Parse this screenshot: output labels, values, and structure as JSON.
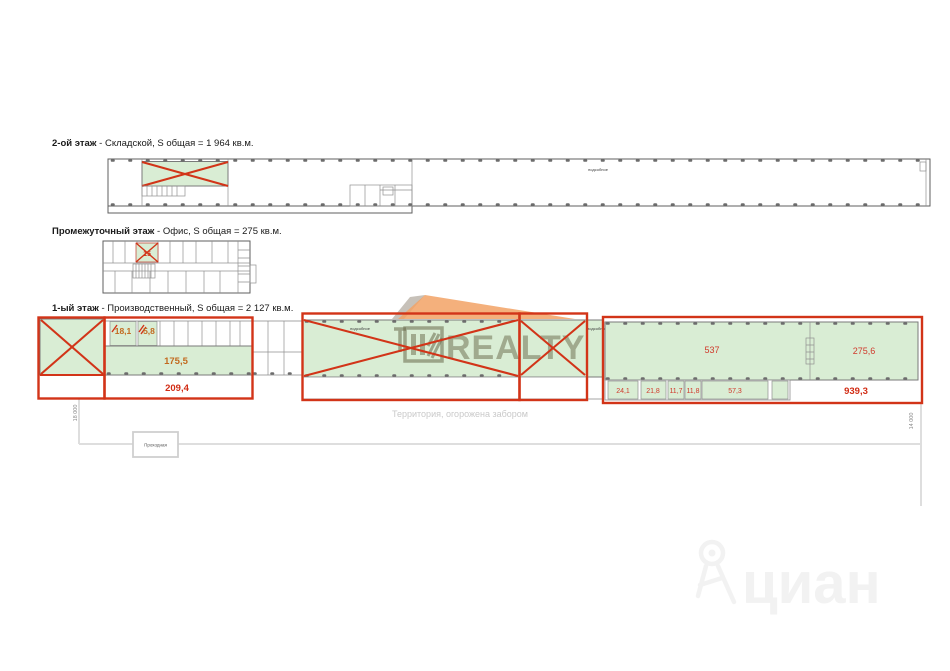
{
  "page": {
    "width": 950,
    "height": 671,
    "background": "#ffffff"
  },
  "floors": [
    {
      "name": "2-ой этаж",
      "info": "- Складской, S общая = 1 964 кв.м."
    },
    {
      "name": "Промежуточный этаж",
      "info": "- Офис, S общая = 275 кв.м."
    },
    {
      "name": "1-ый этаж",
      "info": "- Производственный, S общая = 2 127 кв.м."
    }
  ],
  "plan_labels": {
    "utility": "подсобное",
    "territory": "Территория, огорожена забором",
    "checkpoint": "Проходная",
    "dim_left": "18 000",
    "dim_right": "14 000"
  },
  "areas": {
    "mezz": "15",
    "r18": "18,1",
    "r5": "5,8",
    "r175": "175,5",
    "sum_left": "209,4",
    "r537": "537",
    "r275": "275,6",
    "r24": "24,1",
    "r21": "21,8",
    "r11a": "11,7",
    "r11b": "11,8",
    "r57": "57,3",
    "sum_right": "939,3"
  },
  "watermarks": {
    "realty": "REALTY",
    "cian": "циан"
  },
  "colors": {
    "highlight_green": "#d9edd4",
    "overlay_red": "#d23418",
    "area_red": "#d12c14",
    "area_orange": "#c2691e",
    "fence_gray": "#dedede"
  }
}
